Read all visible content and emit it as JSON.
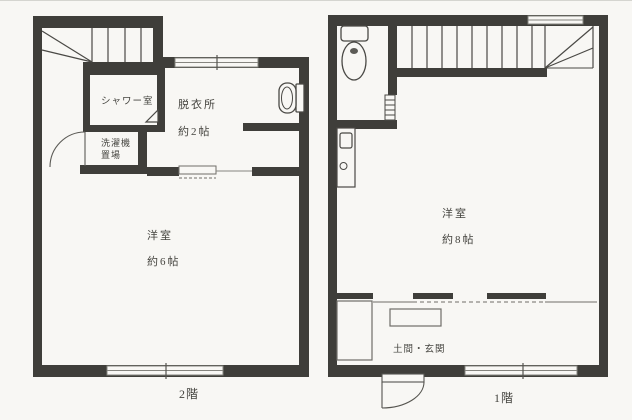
{
  "document": {
    "type": "floor-plan-scan",
    "colors": {
      "wall": "#3f3e3a",
      "thin_line": "#6f6e69",
      "background": "#f8f7f4",
      "text": "#45443f"
    }
  },
  "floor2": {
    "label": "2階",
    "shower_room": "シャワー室",
    "dressing_room": "脱衣所",
    "dressing_size": "約2帖",
    "washer_line1": "洗濯機",
    "washer_line2": "置場",
    "room": "洋室",
    "room_size": "約6帖"
  },
  "floor1": {
    "label": "1階",
    "room": "洋室",
    "room_size": "約8帖",
    "entrance": "土間・玄関"
  }
}
